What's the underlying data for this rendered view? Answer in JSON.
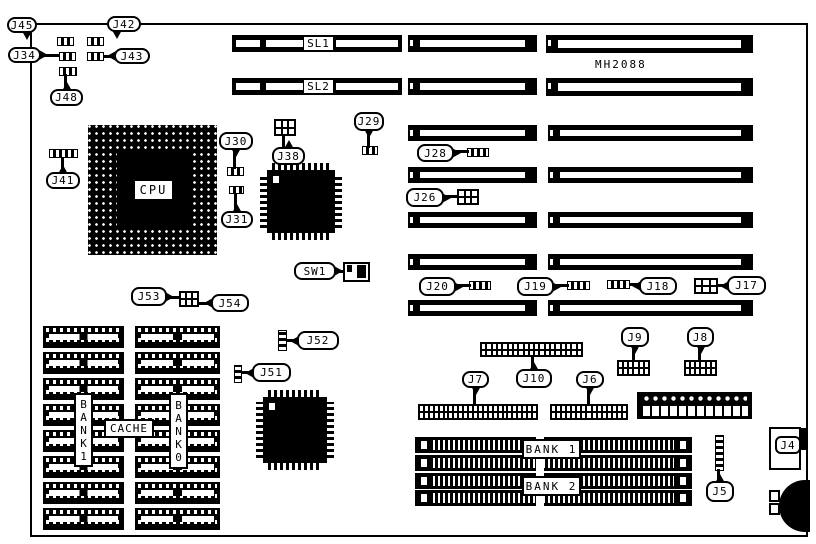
{
  "board": {
    "model_text": "MH2088"
  },
  "slots": {
    "sl1": "SL1",
    "sl2": "SL2"
  },
  "cpu_label": "CPU",
  "memory": {
    "cache_label": "CACHE",
    "bank1_vertical_label": "BANK1",
    "bank0_vertical_label": "BANK0",
    "simm_bank1_label": "BANK 1",
    "simm_bank2_label": "BANK 2"
  },
  "callouts": {
    "j45": "J45",
    "j42": "J42",
    "j34": "J34",
    "j43": "J43",
    "j48": "J48",
    "j41": "J41",
    "j30": "J30",
    "j31": "J31",
    "j38": "J38",
    "j29": "J29",
    "j28": "J28",
    "j26": "J26",
    "sw1": "SW1",
    "j20": "J20",
    "j19": "J19",
    "j18": "J18",
    "j17": "J17",
    "j53": "J53",
    "j54": "J54",
    "j52": "J52",
    "j51": "J51",
    "j9": "J9",
    "j8": "J8",
    "j7": "J7",
    "j10": "J10",
    "j6": "J6",
    "j5": "J5",
    "j4": "J4"
  }
}
